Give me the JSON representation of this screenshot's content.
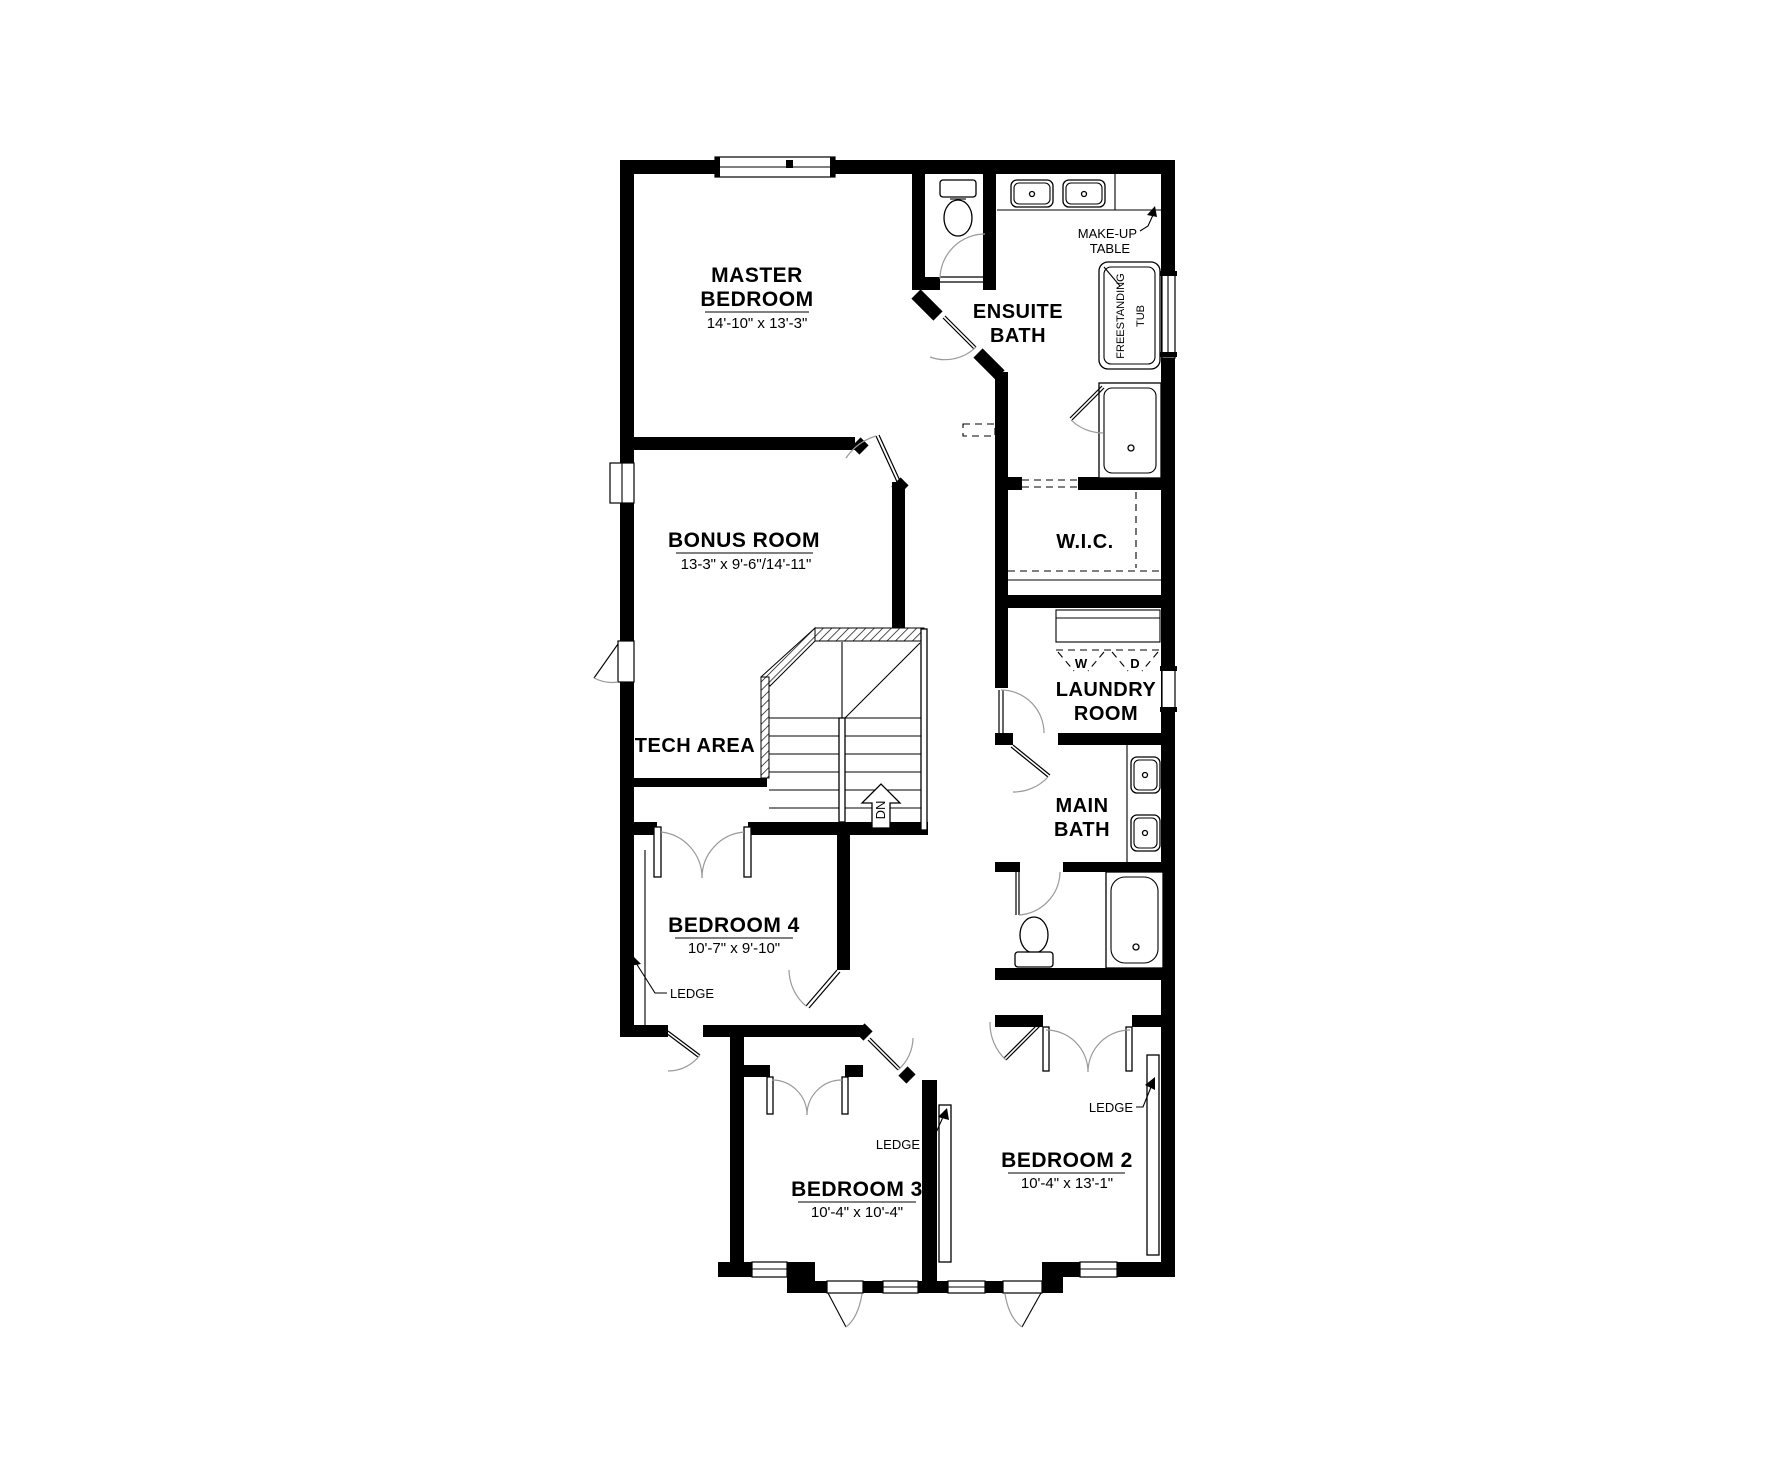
{
  "plan": {
    "rooms": {
      "master_bedroom": {
        "line1": "MASTER",
        "line2": "BEDROOM",
        "dims": "14'-10\" x 13'-3\""
      },
      "ensuite_bath": {
        "line1": "ENSUITE",
        "line2": "BATH"
      },
      "bonus_room": {
        "name": "BONUS ROOM",
        "dims": "13-3\" x 9'-6\"/14'-11\""
      },
      "wic": {
        "name": "W.I.C."
      },
      "laundry_room": {
        "line1": "LAUNDRY",
        "line2": "ROOM"
      },
      "tech_area": {
        "name": "TECH AREA"
      },
      "main_bath": {
        "line1": "MAIN",
        "line2": "BATH"
      },
      "bedroom_4": {
        "name": "BEDROOM 4",
        "dims": "10'-7\" x 9'-10\""
      },
      "bedroom_3": {
        "name": "BEDROOM 3",
        "dims": "10'-4\" x 10'-4\""
      },
      "bedroom_2": {
        "name": "BEDROOM 2",
        "dims": "10'-4\" x 13'-1\""
      }
    },
    "annotations": {
      "makeup_table_line1": "MAKE-UP",
      "makeup_table_line2": "TABLE",
      "freestanding_tub_line1": "FREESTANDING",
      "freestanding_tub_line2": "TUB",
      "ledge": "LEDGE",
      "washer": "W",
      "dryer": "D",
      "down": "DN"
    },
    "colors": {
      "wall": "#000000",
      "door_arc": "#9a9a9a",
      "text": "#000000",
      "background": "#ffffff"
    }
  }
}
